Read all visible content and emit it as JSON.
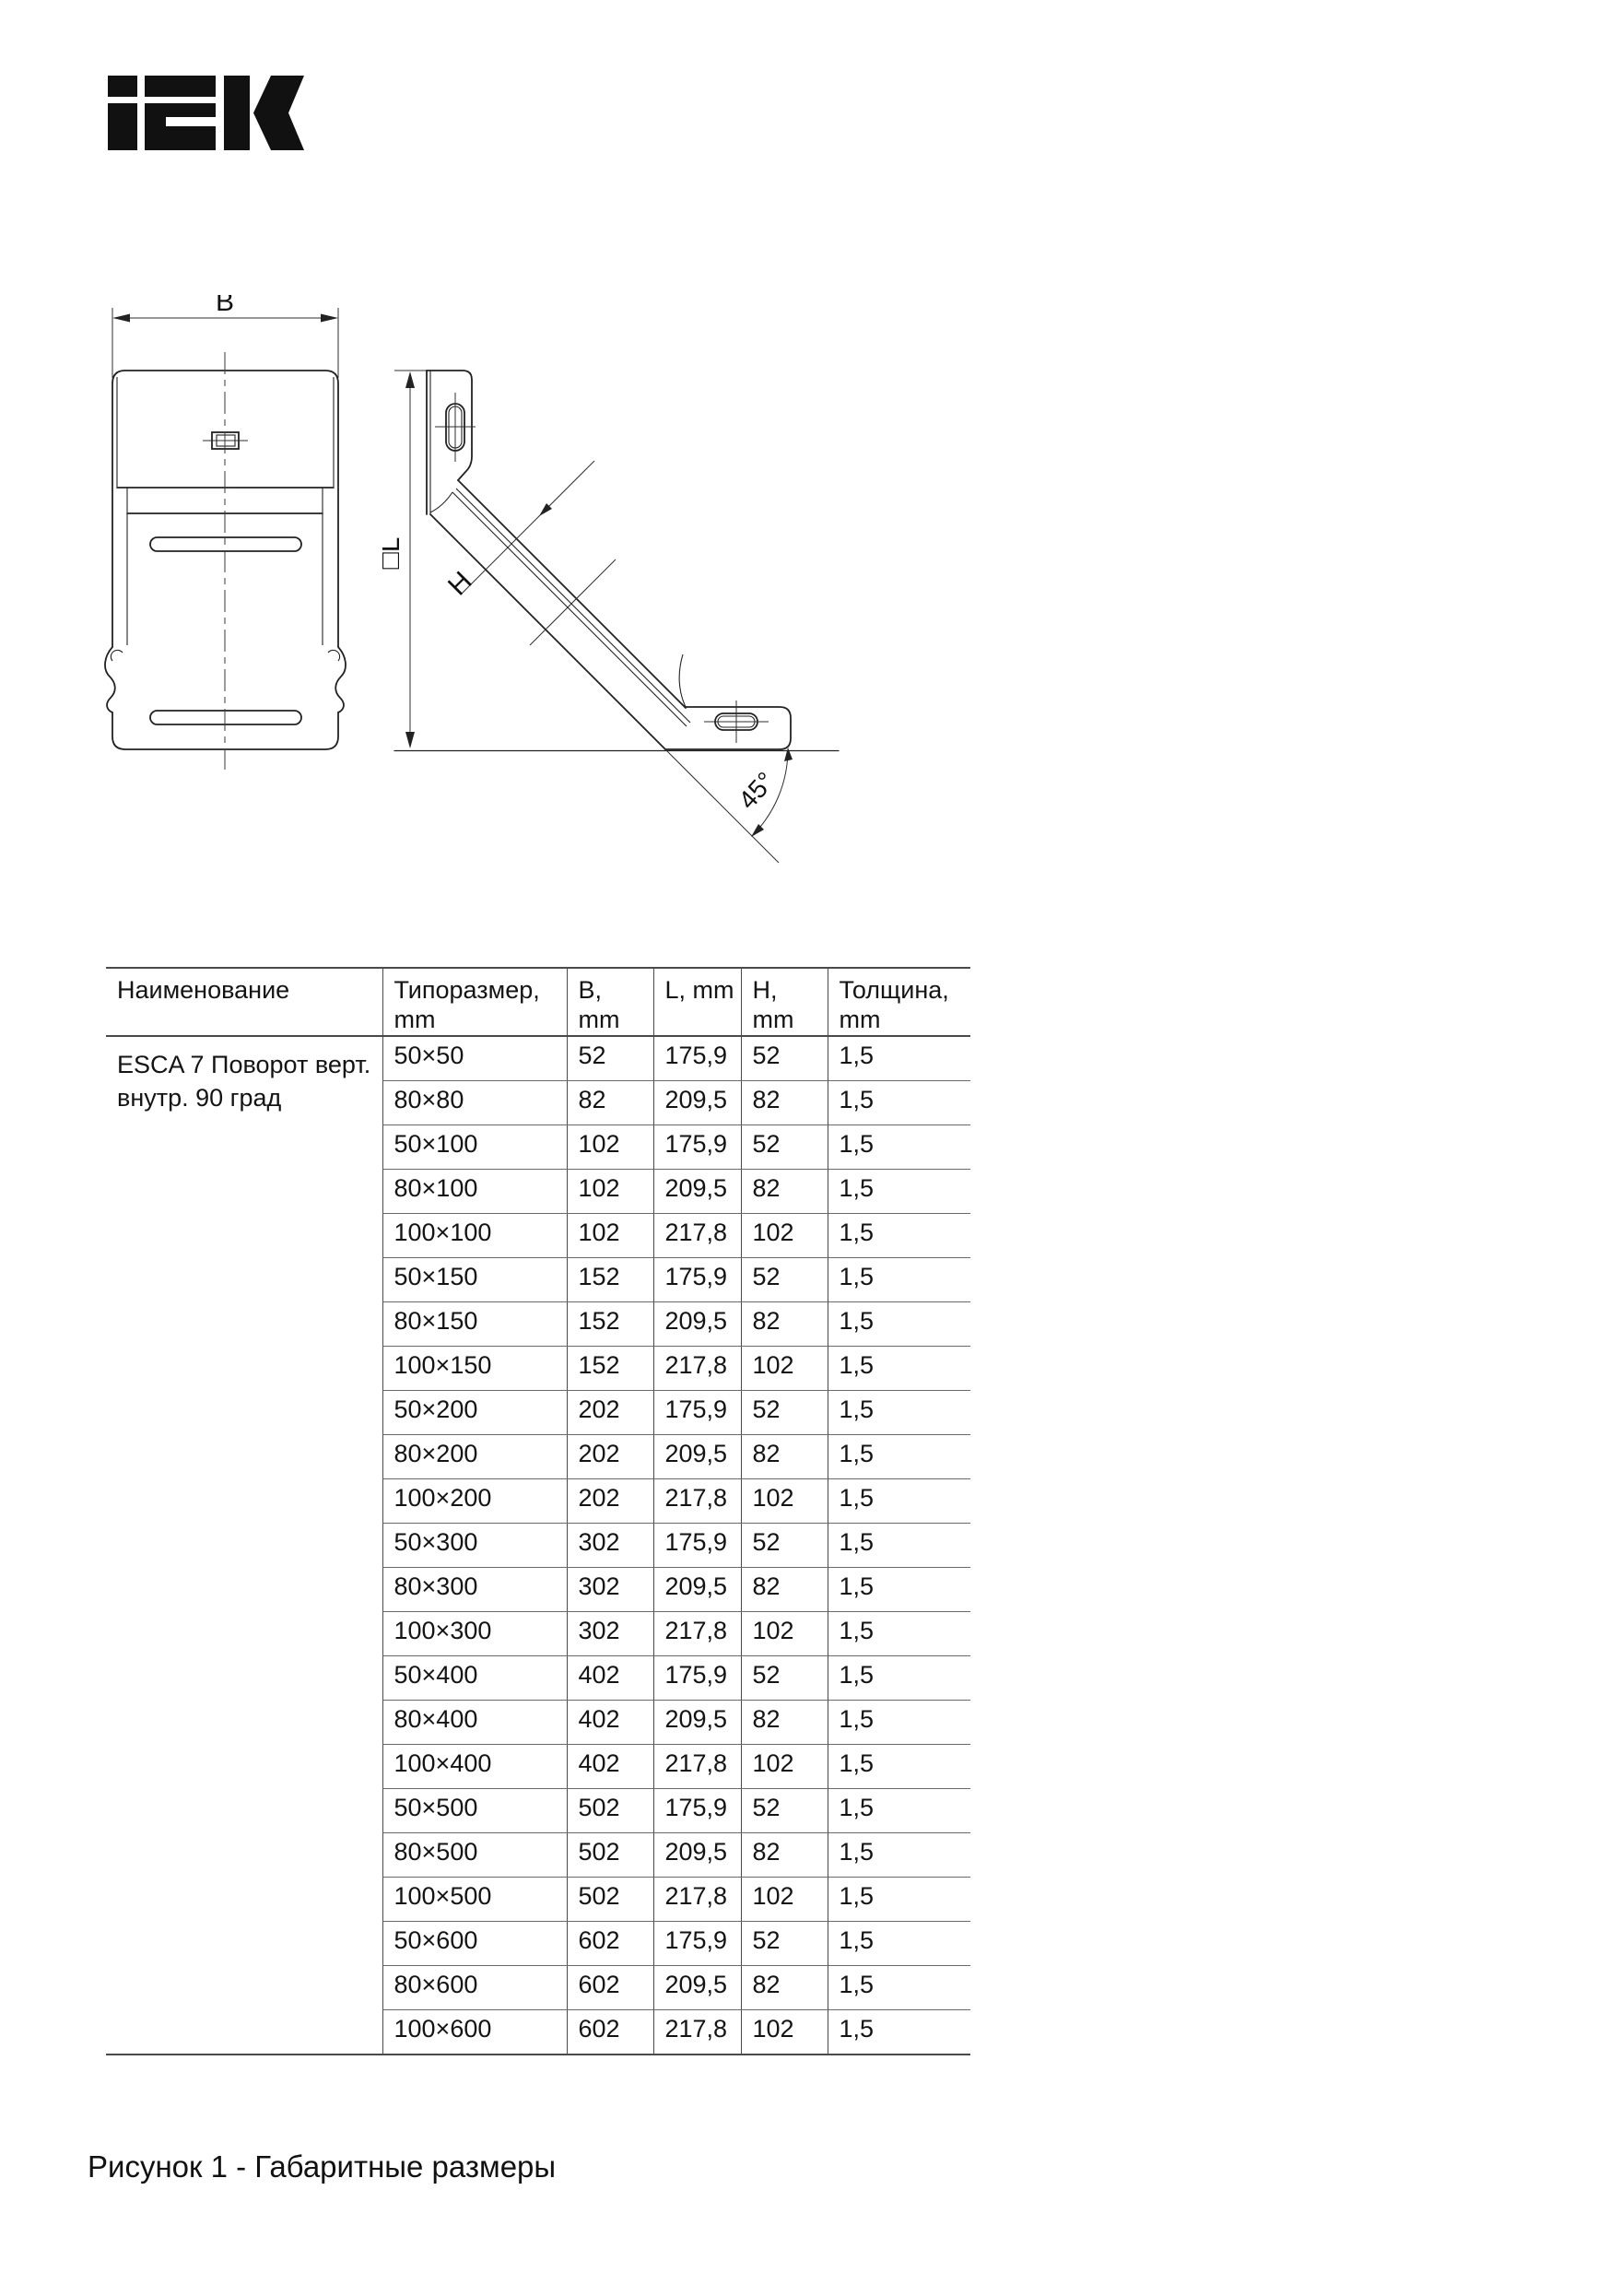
{
  "page": {
    "brand": "IEK",
    "figure_caption": "Рисунок 1 - Габаритные размеры"
  },
  "drawings": {
    "front_view": {
      "width_label": "B"
    },
    "side_view": {
      "length_label": "□L",
      "height_label": "H",
      "angle_label": "45°"
    }
  },
  "table": {
    "headers": [
      "Наименование",
      "Типоразмер, mm",
      "B, mm",
      "L, mm",
      "H, mm",
      "Толщина, mm"
    ],
    "product_name": "ESCA 7 Поворот верт. внутр. 90 град",
    "rows": [
      [
        "50×50",
        "52",
        "175,9",
        "52",
        "1,5"
      ],
      [
        "80×80",
        "82",
        "209,5",
        "82",
        "1,5"
      ],
      [
        "50×100",
        "102",
        "175,9",
        "52",
        "1,5"
      ],
      [
        "80×100",
        "102",
        "209,5",
        "82",
        "1,5"
      ],
      [
        "100×100",
        "102",
        "217,8",
        "102",
        "1,5"
      ],
      [
        "50×150",
        "152",
        "175,9",
        "52",
        "1,5"
      ],
      [
        "80×150",
        "152",
        "209,5",
        "82",
        "1,5"
      ],
      [
        "100×150",
        "152",
        "217,8",
        "102",
        "1,5"
      ],
      [
        "50×200",
        "202",
        "175,9",
        "52",
        "1,5"
      ],
      [
        "80×200",
        "202",
        "209,5",
        "82",
        "1,5"
      ],
      [
        "100×200",
        "202",
        "217,8",
        "102",
        "1,5"
      ],
      [
        "50×300",
        "302",
        "175,9",
        "52",
        "1,5"
      ],
      [
        "80×300",
        "302",
        "209,5",
        "82",
        "1,5"
      ],
      [
        "100×300",
        "302",
        "217,8",
        "102",
        "1,5"
      ],
      [
        "50×400",
        "402",
        "175,9",
        "52",
        "1,5"
      ],
      [
        "80×400",
        "402",
        "209,5",
        "82",
        "1,5"
      ],
      [
        "100×400",
        "402",
        "217,8",
        "102",
        "1,5"
      ],
      [
        "50×500",
        "502",
        "175,9",
        "52",
        "1,5"
      ],
      [
        "80×500",
        "502",
        "209,5",
        "82",
        "1,5"
      ],
      [
        "100×500",
        "502",
        "217,8",
        "102",
        "1,5"
      ],
      [
        "50×600",
        "602",
        "175,9",
        "52",
        "1,5"
      ],
      [
        "80×600",
        "602",
        "209,5",
        "82",
        "1,5"
      ],
      [
        "100×600",
        "602",
        "217,8",
        "102",
        "1,5"
      ]
    ]
  }
}
